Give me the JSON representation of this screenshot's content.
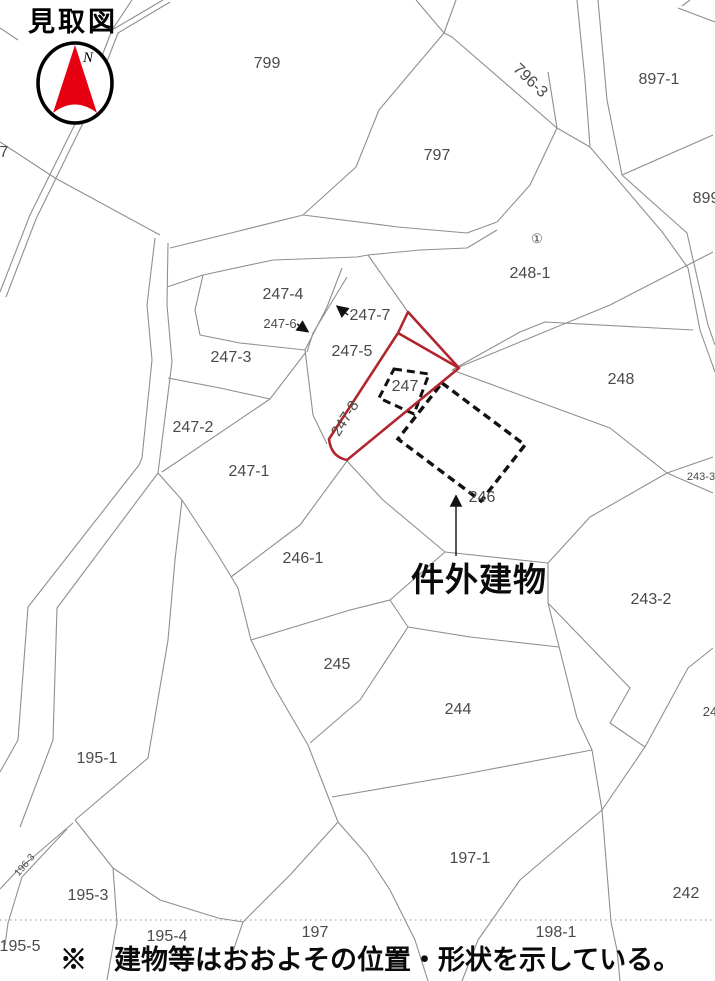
{
  "title": "見取図",
  "bottom_note": "※　建物等はおおよその位置・形状を示している。",
  "annotation": {
    "label": "件外建物",
    "target": "dashed building outline 246/247"
  },
  "compass": {
    "label": "N"
  },
  "colors": {
    "parcel_line": "#8f8f8f",
    "label_gray": "#4a4a4a",
    "highlight_red": "#b1262f",
    "compass_red": "#e60012",
    "dashed_black": "#111111",
    "dotted_line": "#a8a8a8",
    "text_black": "#000000"
  },
  "map": {
    "labels": [
      {
        "text": "799",
        "x": 267,
        "y": 68
      },
      {
        "text": "797",
        "x": 437,
        "y": 160
      },
      {
        "text": "796-3",
        "x": 527,
        "y": 84,
        "rot": 44
      },
      {
        "text": "897-1",
        "x": 659,
        "y": 84
      },
      {
        "text": "899",
        "x": 706,
        "y": 203
      },
      {
        "text": "248-1",
        "x": 530,
        "y": 278
      },
      {
        "text": "①",
        "x": 537,
        "y": 243,
        "size": 13
      },
      {
        "text": "248",
        "x": 621,
        "y": 384
      },
      {
        "text": "243-3",
        "x": 701,
        "y": 480,
        "size": 11
      },
      {
        "text": "243-2",
        "x": 651,
        "y": 604
      },
      {
        "text": "24",
        "x": 710,
        "y": 716,
        "size": 13
      },
      {
        "text": "242",
        "x": 686,
        "y": 898
      },
      {
        "text": "247-4",
        "x": 283,
        "y": 299
      },
      {
        "text": "247-6",
        "x": 280,
        "y": 328,
        "size": 13
      },
      {
        "text": "247-7",
        "x": 370,
        "y": 320
      },
      {
        "text": "247-5",
        "x": 352,
        "y": 356
      },
      {
        "text": "247-3",
        "x": 231,
        "y": 362
      },
      {
        "text": "247-2",
        "x": 193,
        "y": 432
      },
      {
        "text": "247-1",
        "x": 249,
        "y": 476
      },
      {
        "text": "247-8",
        "x": 349,
        "y": 421,
        "rot": -58,
        "size": 15
      },
      {
        "text": "247",
        "x": 405,
        "y": 391
      },
      {
        "text": "246",
        "x": 482,
        "y": 502
      },
      {
        "text": "246-1",
        "x": 303,
        "y": 563
      },
      {
        "text": "245",
        "x": 337,
        "y": 669
      },
      {
        "text": "244",
        "x": 458,
        "y": 714
      },
      {
        "text": "197-1",
        "x": 470,
        "y": 863
      },
      {
        "text": "197",
        "x": 315,
        "y": 937
      },
      {
        "text": "198-1",
        "x": 556,
        "y": 937
      },
      {
        "text": "195-1",
        "x": 97,
        "y": 763
      },
      {
        "text": "196-3",
        "x": 27,
        "y": 867,
        "rot": -50,
        "size": 10
      },
      {
        "text": "195-3",
        "x": 88,
        "y": 900
      },
      {
        "text": "195-4",
        "x": 167,
        "y": 941
      },
      {
        "text": "195-5",
        "x": 20,
        "y": 951
      },
      {
        "text": "7",
        "x": 4,
        "y": 157
      }
    ]
  }
}
